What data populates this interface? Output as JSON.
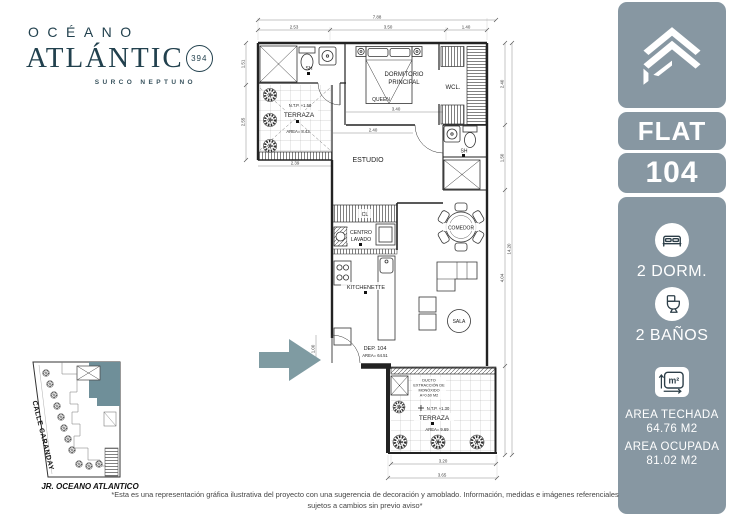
{
  "brand": {
    "name_line1": "OCÉANO",
    "name_line2": "ATLÁNTIC",
    "badge_number": "394",
    "subtitle": "SURCO NEPTUNO",
    "ink_color": "#22414e"
  },
  "sidebar": {
    "flat_label": "FLAT",
    "unit_number": "104",
    "bedrooms_label": "2 DORM.",
    "bathrooms_label": "2 BAÑOS",
    "sqm_symbol": "m²",
    "covered_area_label": "AREA TECHADA",
    "covered_area_value": "64.76 M2",
    "occupied_area_label": "AREA OCUPADA",
    "occupied_area_value": "81.02 M2",
    "panel_color": "#8797a2"
  },
  "plan": {
    "rooms": {
      "dormitorio_line1": "DORMITORIO",
      "dormitorio_line2": "PRINCIPAL",
      "bed_type": "QUEEN",
      "closet": "WCL.",
      "bath_top": "SH",
      "bath_right": "SH",
      "estudio": "ESTUDIO",
      "terraza_upper": "TERRAZA",
      "cl": "CL",
      "laundry_line1": "CENTRO",
      "laundry_line2": "LAVADO",
      "kitchenette": "KITCHENETTE",
      "comedor": "COMEDOR",
      "sala": "SALA",
      "terraza_lower": "TERRAZA"
    },
    "annotations": {
      "unit_title": "DEP. 104",
      "unit_area": "AREA= 64.51",
      "ntp_upper": "N.T.P. +1.50",
      "area_upper": "AREA= 8.43",
      "ntp_lower": "N.T.P. +1.30",
      "area_lower": "AREA= 9.69",
      "duct_line1": "DUCTO",
      "duct_line2": "EXTRACCIÓN DE",
      "duct_line3": "MONÓXIDO",
      "duct_line4": "A=0.60 M2"
    },
    "dimensions": {
      "top_total": "7.88",
      "top_seg1": "2.53",
      "top_seg2": "3.50",
      "top_seg3": "1.40",
      "left_seg1": "1.51",
      "left_seg2": "2.55",
      "below_terrace": "2.39",
      "bed_width": "3.40",
      "estudio_width": "2.40",
      "entry_height": "1.00",
      "right_seg1": "2.40",
      "right_seg2": "1.50",
      "right_seg3": "4.04",
      "right_total": "14.20",
      "bottom_seg": "3.20",
      "bottom_total": "3.65"
    },
    "arrow_color": "#7f9ba2"
  },
  "site_map": {
    "street_left": "CALLE CARANDAY",
    "street_bottom": "JR. OCEANO ATLANTICO",
    "highlight_color": "#6f8f99"
  },
  "disclaimer": "*Esta es una representación gráfica ilustrativa del proyecto con una sugerencia de decoración y amoblado. Información, medidas e imágenes referenciales sujetos a cambios sin previo aviso*"
}
